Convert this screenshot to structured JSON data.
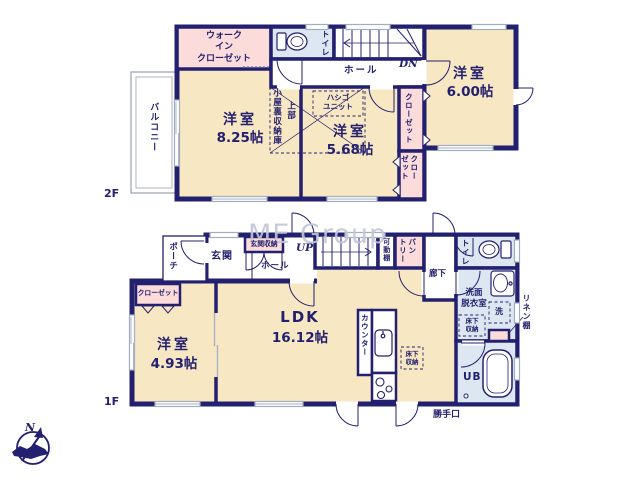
{
  "page": {
    "watermark": "ME Group",
    "compass_n": "N"
  },
  "floor2": {
    "floor_label": "2F",
    "balcony_label": "バルコニー",
    "wic_label": "ウォーク\nイン\nクローゼット",
    "toilet_label": "トイレ",
    "hall_label": "ホール",
    "dn_label": "DN",
    "room_a": {
      "name": "洋室",
      "size": "8.25帖"
    },
    "attic_label": "小屋裏収納庫",
    "attic_label2": "上部",
    "ladder_label": "ハシゴ\nユニット",
    "room_b": {
      "name": "洋室",
      "size": "5.68帖"
    },
    "closet_upper_label": "クローゼット",
    "closet_lower_label": "クロー\nゼット",
    "room_c": {
      "name": "洋室",
      "size": "6.00帖"
    }
  },
  "floor1": {
    "floor_label": "1F",
    "porch_label": "ポーチ",
    "entrance_label": "玄関",
    "entrance_storage_label": "玄関収納",
    "hall_label": "ホール",
    "up_label": "UP",
    "shelf_label": "可動棚",
    "pantry_label": "パン\nトリー",
    "corridor_label": "廊下",
    "toilet_label": "トイレ",
    "washroom_label": "洗面\n脱衣室",
    "laundry_label": "洗",
    "underfloor_wash_label": "床下\n収納",
    "linen_label": "リネン棚",
    "bath_label": "UB",
    "ldk": {
      "name": "LDK",
      "size": "16.12帖"
    },
    "counter_label": "カウンター",
    "underfloor_ldk_label": "床下\n収納",
    "room_d": {
      "name": "洋室",
      "size": "4.93帖"
    },
    "closet_label": "クローゼット",
    "backdoor_label": "勝手口"
  },
  "colors": {
    "wall": "#23206f",
    "room": "#f7e7c3",
    "closet": "#fbdcdb",
    "wet": "#dce7f2",
    "window": "#a3adc2",
    "watermark": "#c2c7d6"
  }
}
